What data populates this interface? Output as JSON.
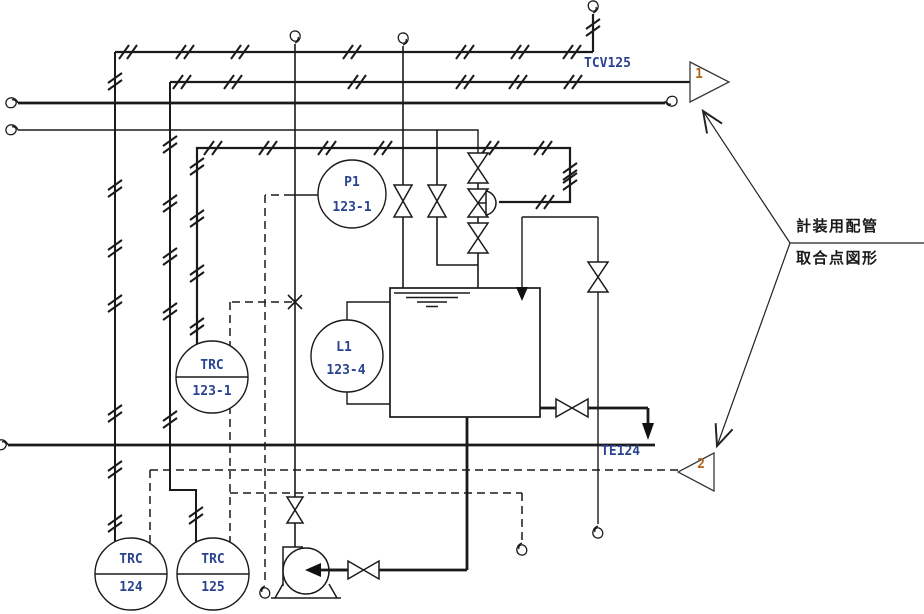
{
  "diagram": {
    "type": "piping-and-instrumentation-diagram",
    "note": {
      "line1": "計装用配管",
      "line2": "取合点図形"
    },
    "connector_up": {
      "number": "1",
      "line_label": "TCV125"
    },
    "connector_down": {
      "number": "2",
      "line_label": "TE124"
    },
    "instruments": {
      "p1": {
        "tag": "P1",
        "loop": "123-1"
      },
      "l1": {
        "tag": "L1",
        "loop": "123-4"
      },
      "trc1231": {
        "tag": "TRC",
        "loop": "123-1"
      },
      "trc124": {
        "tag": "TRC",
        "loop": "124"
      },
      "trc125": {
        "tag": "TRC",
        "loop": "125"
      }
    },
    "colors": {
      "line": "#1a1a1a",
      "instrument_text": "#2a4390",
      "connector_number": "#b4641e",
      "note_text": "#1a1a1a",
      "background": "#ffffff"
    }
  }
}
